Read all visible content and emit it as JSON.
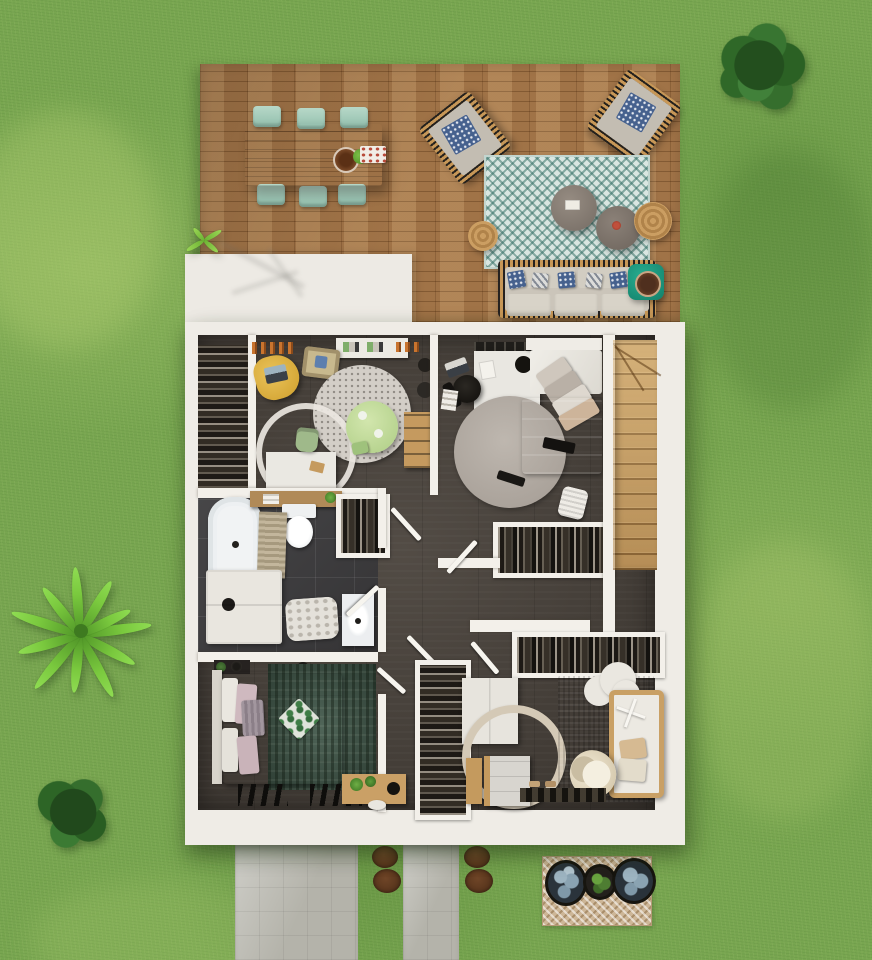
{
  "scene": {
    "description": "Top-down 3D architectural rendering of a house upper floor plan surrounded by a garden lawn, with a wooden terrace at the top, two concrete paths at the bottom and decorative plants",
    "view": "aerial top-down",
    "text_content": "none (image contains no written text)"
  },
  "palette": {
    "grass": "#78a650",
    "deck_wood": "#a87b4e",
    "wall_white": "#efece6",
    "floor_dark": "#49423b",
    "bathroom_tile": "#3d3c3e",
    "stairs_wood": "#c79e63",
    "terrace_rug_teal": "#d9e6e1",
    "mint_chair": "#a5cdbb",
    "accent_side_table": "#1ea08a",
    "yellow_chair": "#dfb43c",
    "bed_mauve": "#cbb4b4",
    "bed_cream": "#d9d4c7",
    "rug_green_vintage": "#41584a",
    "rug_mustard": "#b9891f",
    "concrete_path": "#b4b3aa",
    "pouf_rattan": "#bb8f55"
  },
  "terrace": {
    "material": "wooden plank deck",
    "furniture": [
      "rectangular dining table with six mint green chairs, bowl, plant and food tray",
      "two wicker armchairs with blue patterned cushions",
      "teal chevron outdoor rug",
      "two round coffee tables with tray and flowers",
      "two rattan poufs",
      "wicker sofa with beige cushions and blue patterned pillows",
      "teal side table with wooden bowl"
    ]
  },
  "garden": {
    "lawn": "textured green grass with light and dark patches",
    "plants": [
      "large round bush top right",
      "tropical long-leaf plant mid left",
      "small bush bottom left",
      "grass tuft at deck edge"
    ],
    "paths": [
      "wide concrete walkway",
      "narrow concrete walkway"
    ],
    "planting_circles": "four round brown soil beds",
    "door_mat": "chevron mat with two blue-grey potted plants and one green potted plant"
  },
  "floor_plan": {
    "rooms": [
      {
        "name": "kids room / office",
        "items": [
          "walk-in wardrobe with hanging clothes",
          "white wall shelf",
          "clothes rail with orange garments",
          "yellow bean bag with laptop",
          "play mat",
          "round speckled rug",
          "round green play table with stool",
          "white desk with green chair and white ring rug",
          "wooden bookshelf",
          "two dark baskets"
        ]
      },
      {
        "name": "bedroom",
        "items": [
          "wall clothes rail",
          "white desk",
          "black office chair",
          "laptop on floor",
          "stack of books",
          "round grey rug with black remote",
          "double bed with white headboard, diagonal pillow stack and mauve duvet",
          "black throw",
          "open wardrobe with clothes",
          "white laundry basket"
        ]
      },
      {
        "name": "bathroom",
        "items": [
          "bathtub",
          "wooden shelf with towels",
          "toilet",
          "ribbed beige bath mat",
          "white vanity cabinet with dark kettle",
          "fluffy white rug",
          "washbasin unit",
          "linen closet with clothes"
        ]
      },
      {
        "name": "hallway",
        "items": [
          "four open door leaves",
          "long built-in wardrobe with hanging clothes",
          "narrow closet with hanging clothes"
        ]
      },
      {
        "name": "master bedroom",
        "items": [
          "double bed with cream duvet, pink and grey pillows and green leaf cushion",
          "dark green vintage rug",
          "bedside plants in black pots",
          "two black folding benches",
          "light wooden desk with plants",
          "white stool"
        ]
      },
      {
        "name": "nursery",
        "items": [
          "white wardrobe",
          "round beige canopy ring",
          "changing cabinet",
          "small wooden shelf",
          "mustard rug",
          "white cloud rug",
          "wooden crib with cross mobile and beige pillows",
          "cream rocker chair",
          "dark shoe bench"
        ]
      },
      {
        "name": "staircase",
        "items": [
          "wooden winder staircase descending"
        ]
      }
    ]
  }
}
